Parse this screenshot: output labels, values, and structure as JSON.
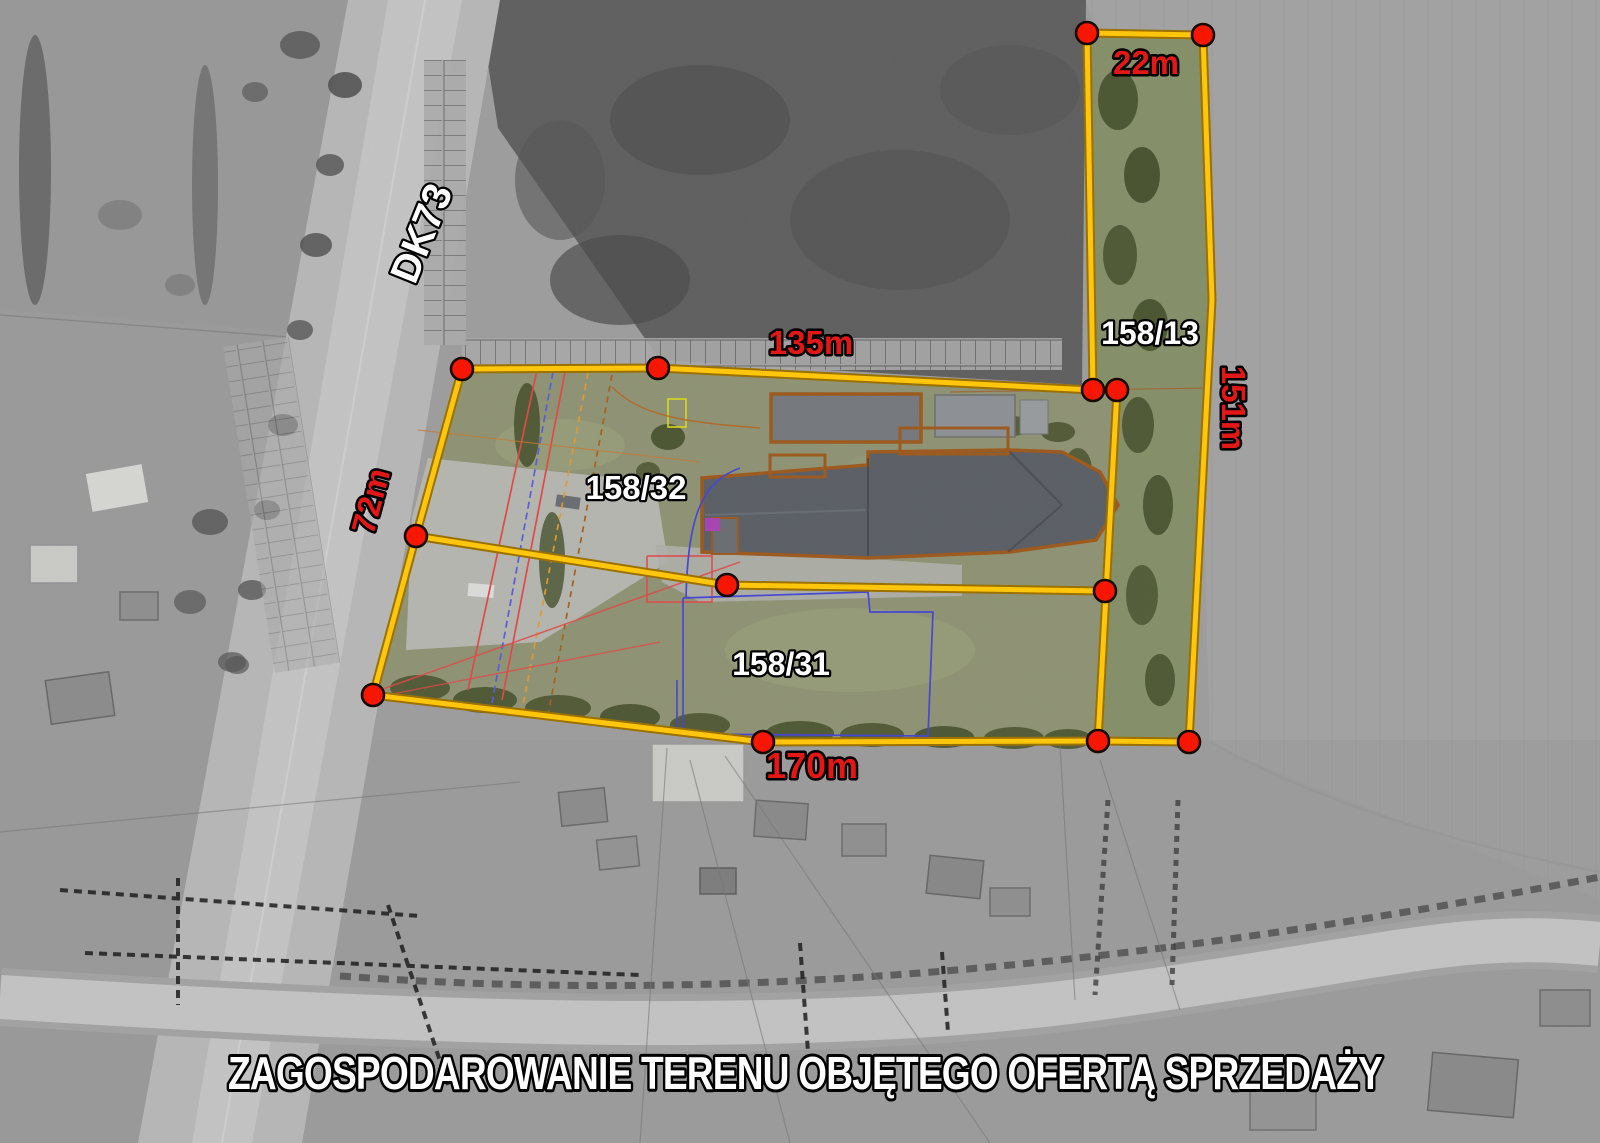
{
  "title": {
    "text": "ZAGOSPODAROWANIE TERENU OBJĘTEGO OFERTĄ SPRZEDAŻY"
  },
  "road": {
    "label": "DK73"
  },
  "parcels": {
    "p158_13": {
      "id": "158/13"
    },
    "p158_32": {
      "id": "158/32"
    },
    "p158_31": {
      "id": "158/31"
    }
  },
  "measurements": {
    "strip_width": {
      "label": "22m"
    },
    "north_side": {
      "label": "135m"
    },
    "east_side": {
      "label": "151m"
    },
    "west_side": {
      "label": "72m"
    },
    "south_side": {
      "label": "170m"
    }
  },
  "colors": {
    "boundary_yellow": "#FFC60A",
    "boundary_edge": "#9A7000",
    "vertex_red": "#F81500",
    "measurement_text": "#E41717",
    "parcel_text": "#FFFFFF",
    "text_outline": "#000000"
  }
}
